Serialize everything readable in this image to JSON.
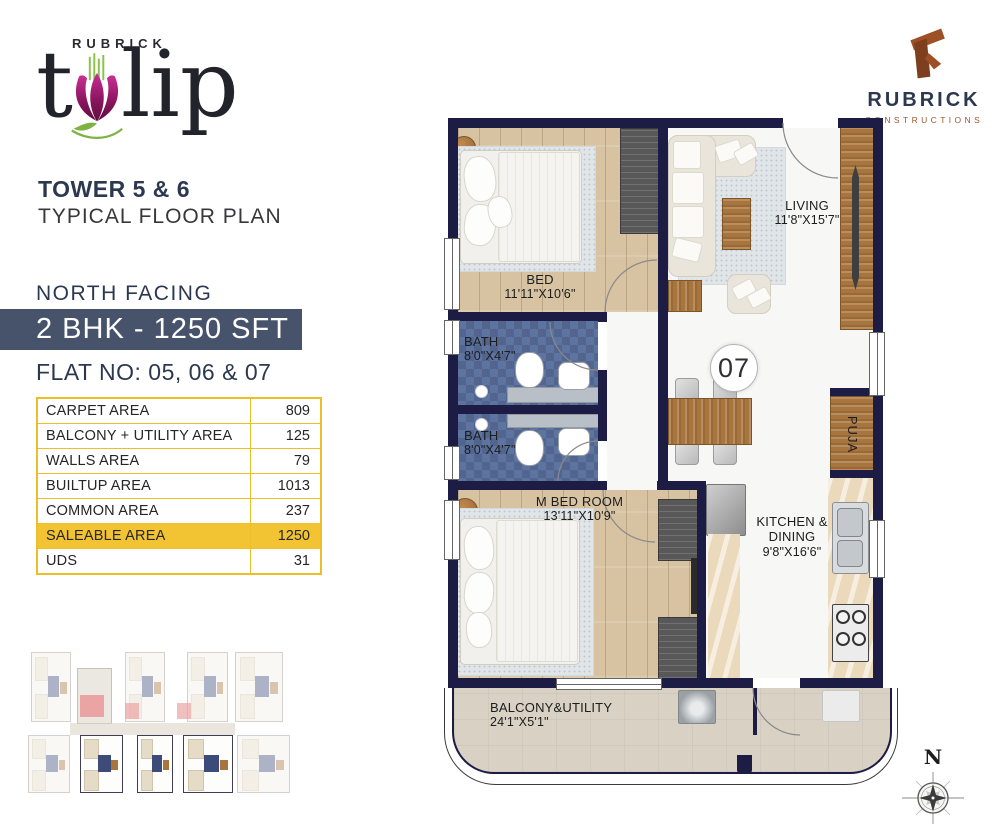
{
  "logo": {
    "brand": "RUBRICK",
    "word_left": "t",
    "word_right": "lip"
  },
  "builder": {
    "name": "RUBRICK",
    "tagline": "CONSTRUCTIONS"
  },
  "info": {
    "tower": "TOWER 5 & 6",
    "plan_type": "TYPICAL FLOOR PLAN",
    "facing": "NORTH FACING",
    "unit_type": "2 BHK - 1250 SFT",
    "flat_no": "FLAT NO: 05, 06 & 07"
  },
  "area_table": {
    "rows": [
      {
        "label": "CARPET AREA",
        "value": "809"
      },
      {
        "label": "BALCONY + UTILITY AREA",
        "value": "125"
      },
      {
        "label": "WALLS AREA",
        "value": "79"
      },
      {
        "label": "BUILTUP AREA",
        "value": "1013"
      },
      {
        "label": "COMMON AREA",
        "value": "237"
      },
      {
        "label": "SALEABLE AREA",
        "value": "1250"
      },
      {
        "label": "UDS",
        "value": "31"
      }
    ]
  },
  "floorplan": {
    "unit_number": "07",
    "rooms": {
      "bed": {
        "label": "BED",
        "dim": "11'11\"X10'6\""
      },
      "bath": {
        "label": "BATH",
        "dim": "8'0\"X4'7\""
      },
      "living": {
        "label": "LIVING",
        "dim": "11'8\"X15'7\""
      },
      "master": {
        "label": "M BED ROOM",
        "dim": "13'11\"X10'9\""
      },
      "kitchen": {
        "line1": "KITCHEN &",
        "line2": "DINING",
        "dim": "9'8\"X16'6\""
      },
      "puja": {
        "label": "PUJA"
      },
      "balcony": {
        "label": "BALCONY&UTILITY",
        "dim": "24'1\"X5'1\""
      }
    },
    "compass": {
      "north": "N"
    }
  },
  "colors": {
    "wall_navy": "#1c1c44",
    "bar_navy": "#47536b",
    "table_gold": "#edbe2a",
    "highlight_gold": "#f2c332",
    "brand_magenta": "#b01e7f",
    "brand_green": "#7cb342",
    "brick_brown": "#9d5026"
  }
}
